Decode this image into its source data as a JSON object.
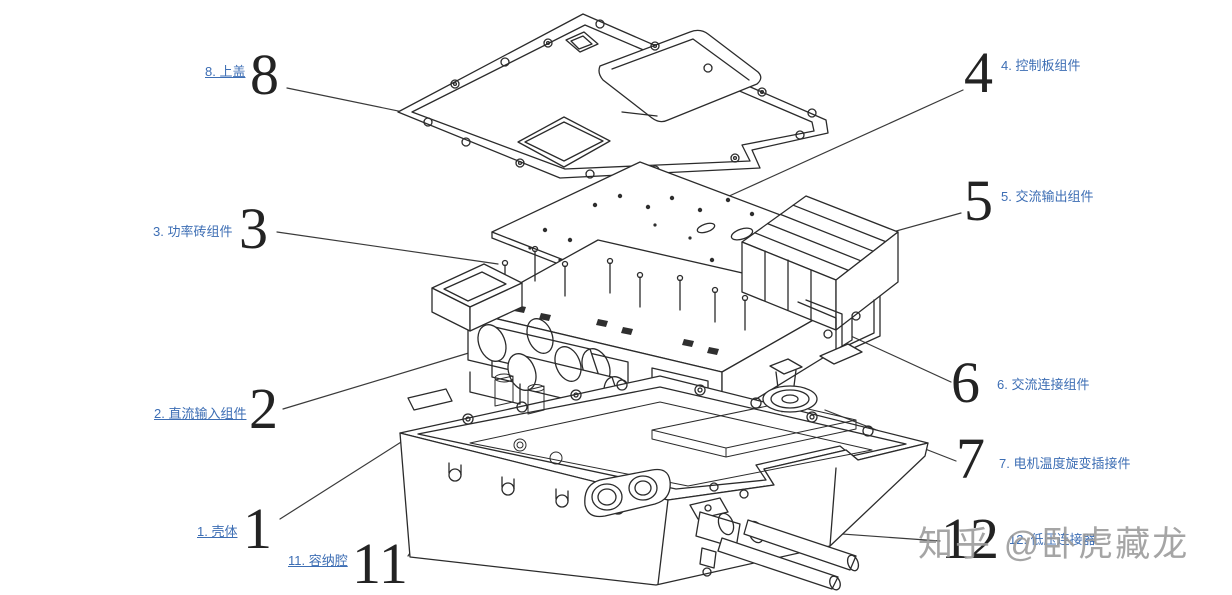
{
  "figure": {
    "type": "exploded-view-technical-diagram",
    "subject": "电机控制器爆炸图",
    "colors": {
      "background": "#ffffff",
      "line": "#2b2b2b",
      "label_text": "#3d6eb4",
      "number_text": "#232323",
      "watermark": "#989898"
    }
  },
  "labels": [
    {
      "key": "top-cover",
      "number": "8",
      "text": "8. 上盖",
      "underline": true
    },
    {
      "key": "control-board",
      "number": "4",
      "text": "4. 控制板组件",
      "underline": false
    },
    {
      "key": "ac-output",
      "number": "5",
      "text": "5. 交流输出组件",
      "underline": false
    },
    {
      "key": "power-brick",
      "number": "3",
      "text": "3. 功率砖组件",
      "underline": false
    },
    {
      "key": "ac-connection",
      "number": "6",
      "text": "6. 交流连接组件",
      "underline": false
    },
    {
      "key": "dc-input",
      "number": "2",
      "text": "2. 直流输入组件",
      "underline": true
    },
    {
      "key": "resolver-plug",
      "number": "7",
      "text": "7. 电机温度旋变插接件",
      "underline": false
    },
    {
      "key": "housing",
      "number": "1",
      "text": "1. 壳体",
      "underline": true
    },
    {
      "key": "cavity",
      "number": "11",
      "text": "11. 容纳腔",
      "underline": true
    },
    {
      "key": "lv-connector",
      "number": "12",
      "text": "12. 低压连接器",
      "underline": false
    }
  ],
  "watermark": {
    "text": "知乎 @卧虎藏龙"
  }
}
